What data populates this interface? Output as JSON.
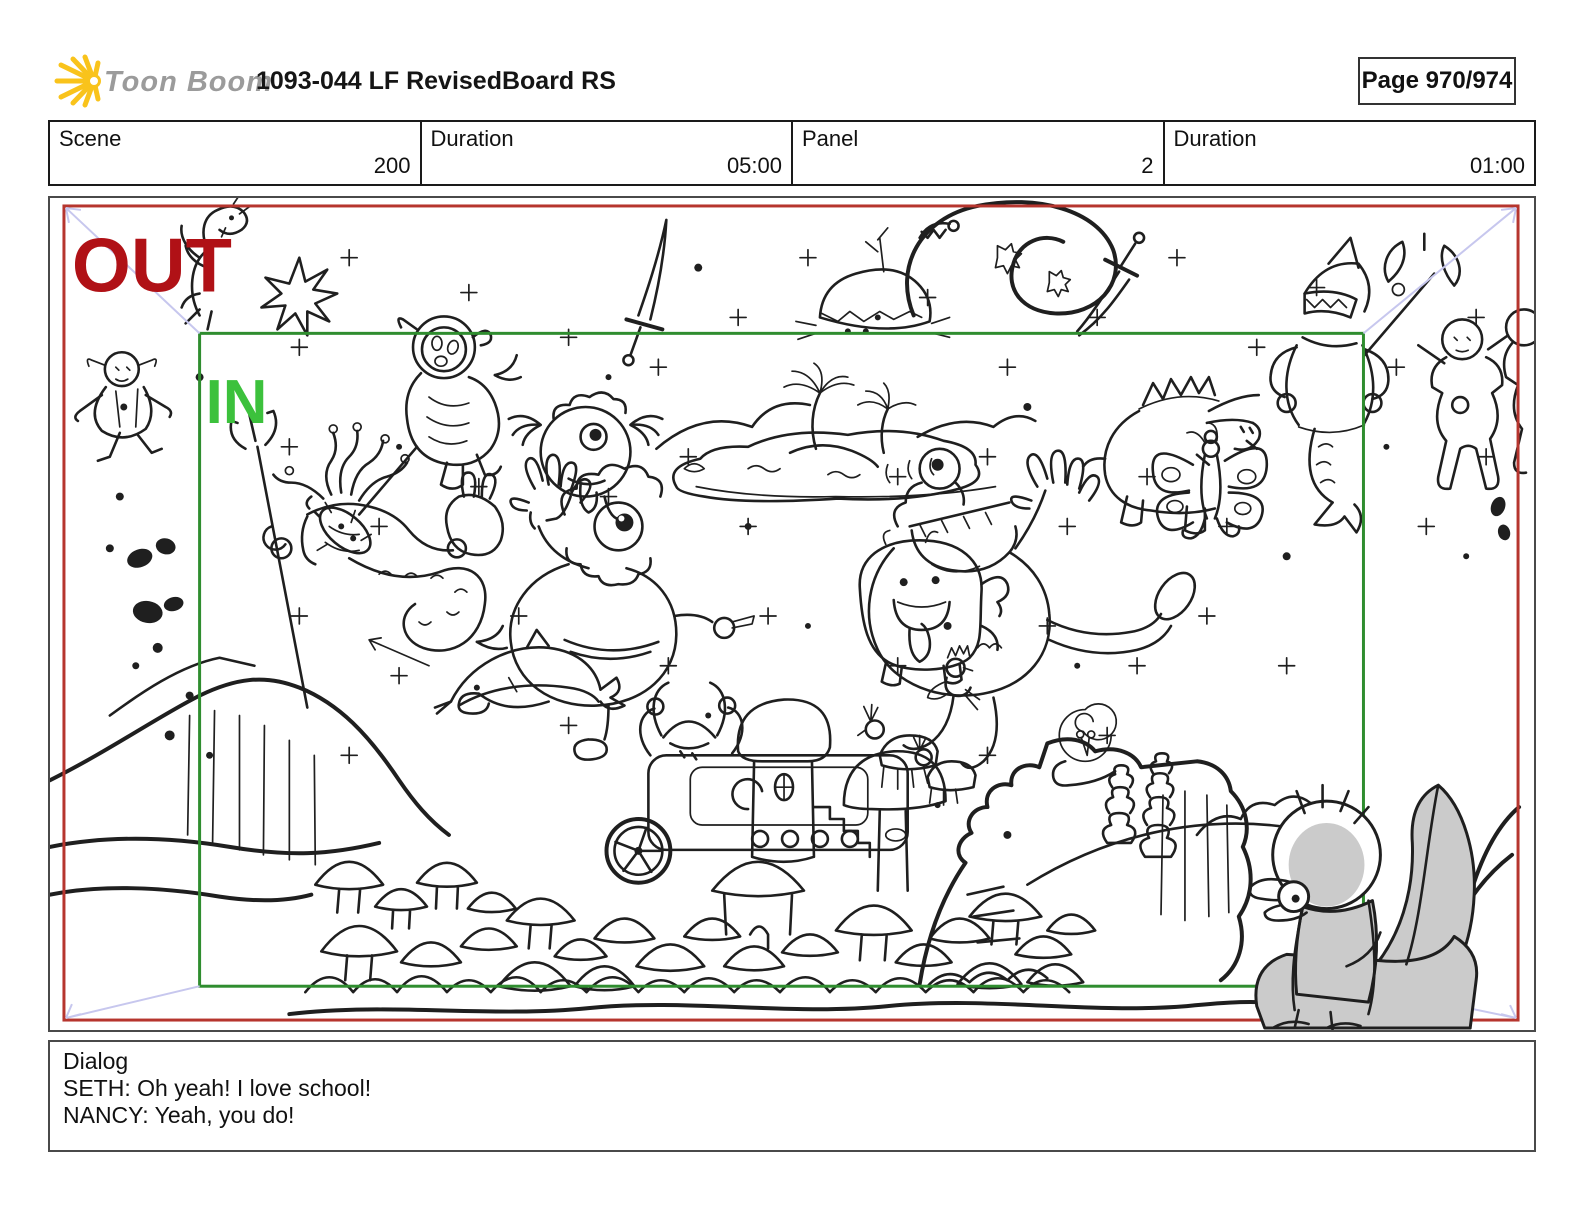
{
  "header": {
    "logo_icon": "starburst-sun-icon",
    "logo_text": "Toon Boom",
    "title": "1093-044 LF RevisedBoard RS",
    "page_label": "Page 970/974"
  },
  "info_row": {
    "cells": [
      {
        "label": "Scene",
        "value": "200"
      },
      {
        "label": "Duration",
        "value": "05:00"
      },
      {
        "label": "Panel",
        "value": "2"
      },
      {
        "label": "Duration",
        "value": "01:00"
      }
    ]
  },
  "panel": {
    "out_label": "OUT",
    "in_label": "IN",
    "colors": {
      "out_frame": "#b6352e",
      "out_text": "#b01116",
      "in_frame": "#2f8d2f",
      "in_text": "#3cc13c",
      "camera_path": "#c7c7ee",
      "ink": "#1f1f1f",
      "creature_shade": "#cbcbcb",
      "logo_yellow": "#f9c31b",
      "logo_gray": "#9b9b9b"
    }
  },
  "dialog": {
    "heading": "Dialog",
    "lines": [
      "SETH: Oh yeah! I love school!",
      "NANCY: Yeah, you do!"
    ]
  }
}
